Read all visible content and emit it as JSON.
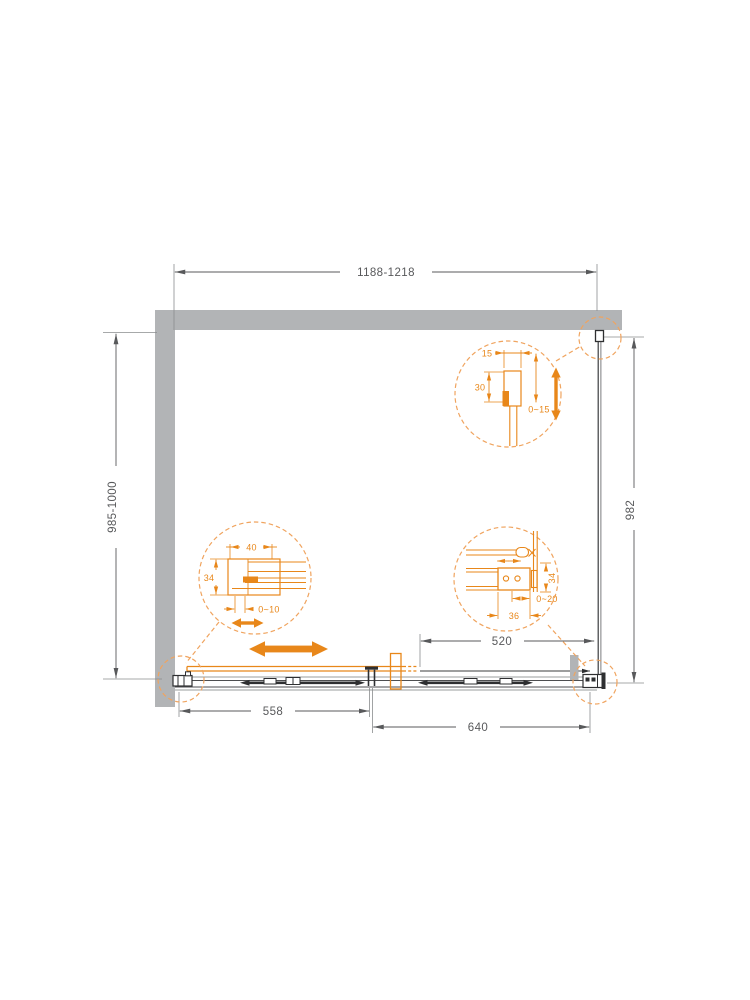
{
  "drawing": {
    "type": "shower-enclosure-plan-view-technical-drawing",
    "dim_labels": {
      "overall_width": "1188-1218",
      "overall_height": "985-1000",
      "panel_height": "982",
      "opening_width": "520",
      "left_section_width": "558",
      "right_section_width": "640"
    },
    "detail_top_right": {
      "profile_width": "15",
      "profile_depth": "30",
      "adjustment_range": "0~15"
    },
    "detail_middle_left": {
      "profile_width": "40",
      "profile_depth": "34",
      "adjustment_range": "0~10"
    },
    "detail_middle_right": {
      "bracket_depth": "34",
      "adjustment_range": "0~20",
      "bracket_width": "36"
    },
    "colors": {
      "accent_orange": "#E8871A",
      "callout_orange": "#F0A45F",
      "wall_gray": "#B2B4B6",
      "object_dark": "#3E3F41",
      "dimension_gray": "#58595B"
    }
  }
}
